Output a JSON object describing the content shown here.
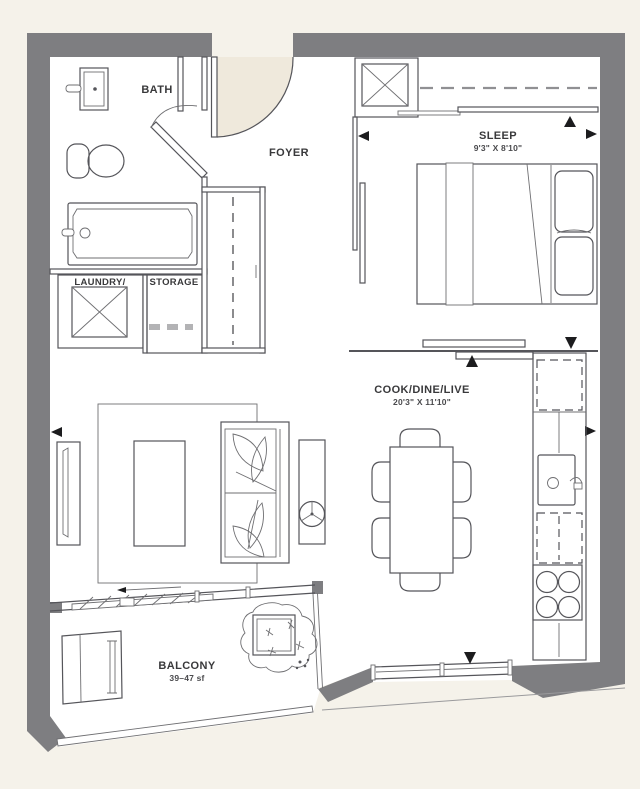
{
  "plan": {
    "type": "floorplan",
    "rooms": {
      "bath": {
        "label": "BATH"
      },
      "foyer": {
        "label": "FOYER"
      },
      "sleep": {
        "label": "SLEEP",
        "dimensions": "9'3\" X 8'10\""
      },
      "laundry": {
        "label": "LAUNDRY/"
      },
      "storage": {
        "label": "STORAGE"
      },
      "cook_dine_live": {
        "label": "COOK/DINE/LIVE",
        "dimensions": "20'3\" X 11'10\""
      },
      "balcony": {
        "label": "BALCONY",
        "area": "39–47 sf"
      }
    },
    "colors": {
      "background": "#f5f2ea",
      "floor": "#ffffff",
      "wall": "#7e7e81",
      "door_swing": "#efe9dc",
      "line": "#55555a",
      "text": "#39393b",
      "marker": "#1c1c1e"
    },
    "fixtures": [
      "vanity-sink",
      "toilet",
      "bathtub",
      "washer-dryer",
      "storage-shelf",
      "coat-closet",
      "wardrobe-closet",
      "queen-bed",
      "pillows",
      "pocket-door",
      "sliding-partition",
      "dining-table",
      "dining-chairs",
      "fridge",
      "kitchen-sink",
      "dishwasher",
      "cooktop",
      "tv-console",
      "rug",
      "coffee-table",
      "sofa",
      "side-table",
      "sliding-balcony-door",
      "balcony-bench",
      "planter",
      "railing"
    ]
  }
}
